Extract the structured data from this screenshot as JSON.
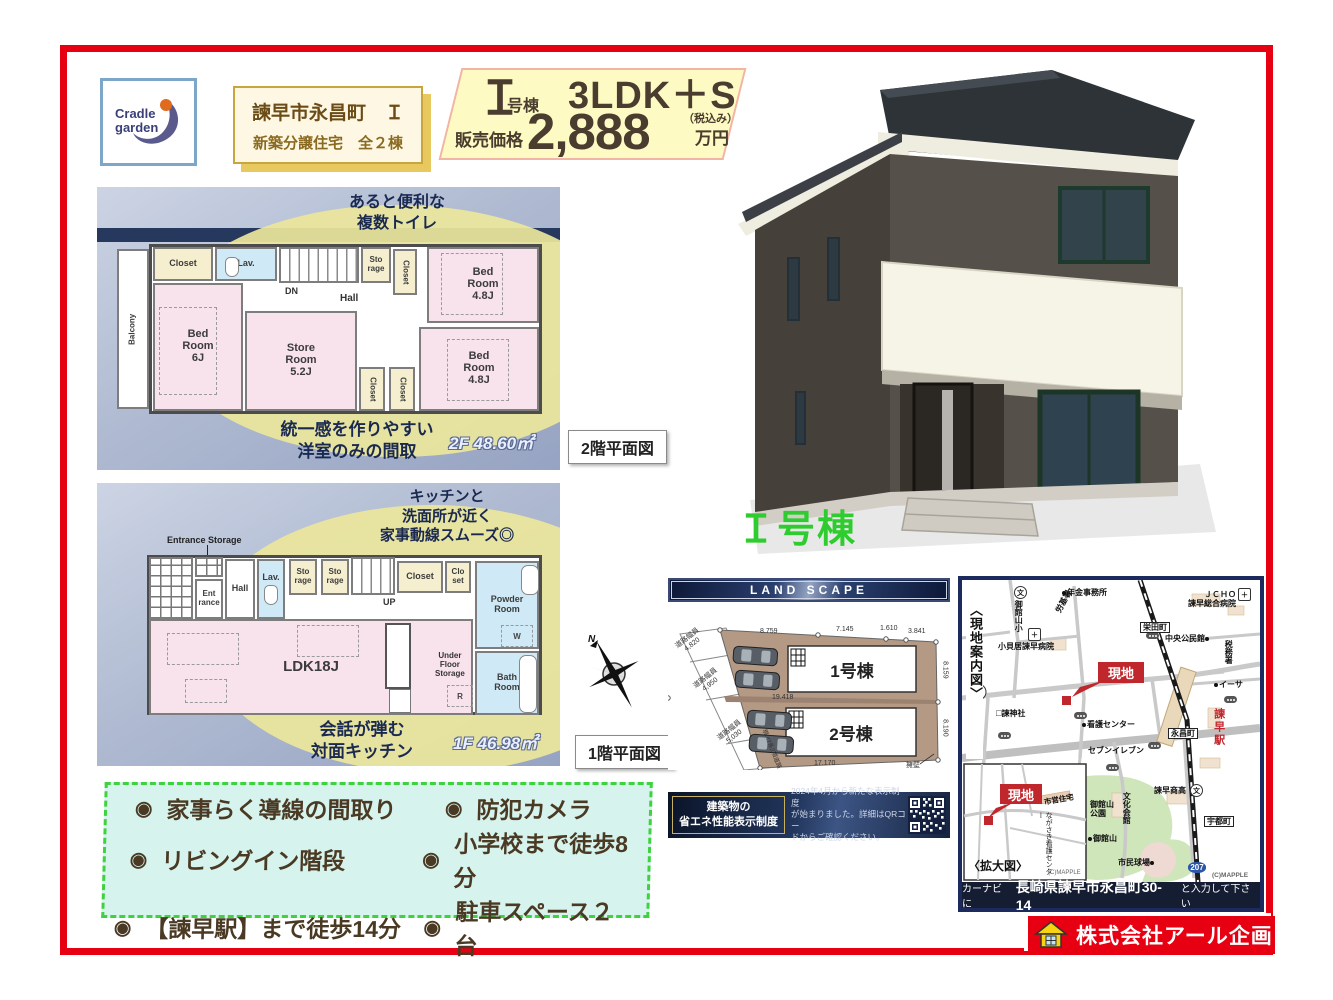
{
  "colors": {
    "frame_red": "#e60012",
    "accent_green": "#2ecc2e",
    "navy_band": "#27385f",
    "price_yellow": "#fdfbc3",
    "feature_border_green": "#3fd23f",
    "site_marker_red": "#c0272d",
    "company_red": "#e60012"
  },
  "brand": {
    "line1": "Cradle",
    "line2": "garden"
  },
  "title_box": {
    "line1": "諫早市永昌町　Ｉ",
    "line2": "新築分譲住宅　全２棟"
  },
  "price": {
    "unit_num": "Ｉ",
    "unit_suffix": "号棟",
    "plan": "3LDK＋S",
    "label": "販売価格",
    "value": "2,888",
    "tax": "（税込み）",
    "yen": "万円"
  },
  "house_caption": "Ｉ号棟",
  "compass": {
    "n": "N"
  },
  "plan_tags": {
    "f2": "2階平面図",
    "f1": "1階平面図"
  },
  "plan2f": {
    "callout_top": "あると便利な\n複数トイレ",
    "callout_bottom": "統一感を作りやすい\n洋室のみの間取",
    "area": "2F 48.60㎡",
    "rooms": {
      "balcony": "Balcony",
      "closet_tl": "Closet",
      "lav": "Lav.",
      "dn": "DN",
      "hall": "Hall",
      "storage": "Sto\nrage",
      "closet_top": "Closet",
      "bed_tr": "Bed\nRoom\n4.8J",
      "bed_left": "Bed\nRoom\n6J",
      "store": "Store\nRoom\n5.2J",
      "closet_b1": "Closet",
      "closet_b2": "Closet",
      "bed_br": "Bed\nRoom\n4.8J"
    }
  },
  "plan1f": {
    "callout_top": "キッチンと\n洗面所が近く\n家事動線スムーズ◎",
    "callout_bottom": "会話が弾む\n対面キッチン",
    "area": "1F 46.98㎡",
    "rooms": {
      "ent_storage": "Entrance Storage",
      "entrance": "Ent\nrance",
      "hall": "Hall",
      "lav": "Lav.",
      "sto1": "Sto\nrage",
      "sto2": "Sto\nrage",
      "up": "UP",
      "closet": "Closet",
      "closet2": "Clo\nset",
      "powder": "Powder\nRoom",
      "w": "W",
      "ldk": "LDK18J",
      "ufs": "Under\nFloor\nStorage",
      "r": "R",
      "bath": "Bath\nRoom"
    }
  },
  "features": [
    "家事らく導線の間取り",
    "防犯カメラ",
    "リビングイン階段",
    "小学校まで徒歩8分",
    "【諫早駅】まで徒歩14分",
    "駐車スペース２台"
  ],
  "landscape": {
    "header": "LAND SCAPE",
    "lot1": "1号棟",
    "lot2": "2号棟",
    "roads": [
      "道路幅員\n4,820",
      "道路幅員\n4,950",
      "道路幅員\n5,030"
    ],
    "dims": {
      "top1": "8.759",
      "top2": "7.145",
      "top3": "1.610",
      "top4": "3.841",
      "mid": "19.418",
      "bottom": "17.170",
      "right1": "8.159",
      "right2": "8.190"
    },
    "wall": "擁壁",
    "road_note": "現:42条2項道路"
  },
  "energy": {
    "title": "建築物の\n省エネ性能表示制度",
    "desc": "2024年4月から新たな表示制度\nが始まりました。詳細はQRコー\nドからご確認ください。"
  },
  "map": {
    "side_label": "〈現地案内図〉",
    "genchi": "現地",
    "inset_label": "〈拡大図〉",
    "credit": "(C)MAPPLE",
    "labels": {
      "nenkin": "年金事務所",
      "rokisho": "労基署",
      "school_nw": "御館山小",
      "hospital_w": "小貝居諫早病院",
      "jinja": "諫神社",
      "kango_center": "看護センター",
      "seven": "セブンイレブン",
      "sakaedamachi": "栄田町",
      "jcho": "ＪＣＨＯ\n諫早総合病院",
      "chuo": "中央公民館",
      "zeimusho": "税務署",
      "iisa": "イーサ",
      "station": "諫早駅",
      "eishomachi": "永昌町",
      "shoko": "諫早商高",
      "bunka": "文化会館",
      "park": "御館山\n公園",
      "mitakeyama": "御館山",
      "kyujo": "市民球場",
      "utomachi": "宇都町",
      "route207": "207",
      "shiei": "市営住宅",
      "nagasaki_kango": "ながさき看護センター"
    },
    "navi": {
      "prefix": "カーナビに",
      "address": "長崎県諫早市永昌町30-14",
      "suffix": "と入力して下さい"
    }
  },
  "company": {
    "name": "株式会社アール企画"
  }
}
